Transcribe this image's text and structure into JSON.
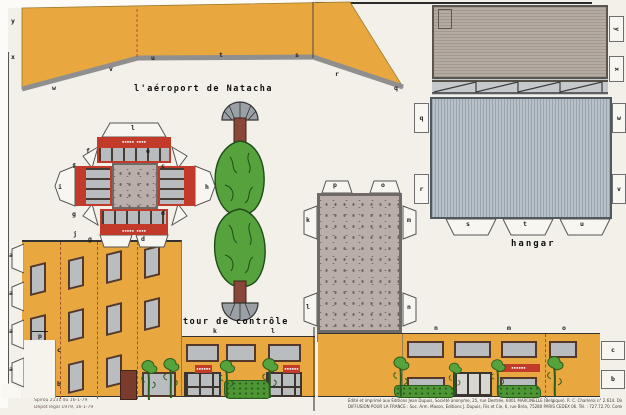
{
  "captions": {
    "airport_title": "l'aéroport de Natacha",
    "tower": "tour de contrôle",
    "hangar": "hangar"
  },
  "tab_letters": {
    "tarmac_left": [
      "y",
      "x"
    ],
    "tarmac_bottom": [
      "w",
      "v",
      "u",
      "t",
      "s",
      "r",
      "q"
    ],
    "roof_right": [
      "y",
      "x"
    ],
    "hangar_left": [
      "q",
      "r"
    ],
    "hangar_right": [
      "w",
      "v"
    ],
    "hangar_bottom": [
      "s",
      "t",
      "u"
    ],
    "tower": {
      "top": "l",
      "corner_tl": "f",
      "corner_tr": "e",
      "corner_r": "c",
      "corner_l": "f",
      "left": "i",
      "right": "h",
      "corner_bl": "g",
      "corner_br": "d",
      "bottom_l": "g",
      "bottom_r": "d"
    },
    "terminal_roof": {
      "top": [
        "p",
        "o"
      ],
      "right": [
        "m",
        "n"
      ],
      "left": [
        "k",
        "l"
      ]
    },
    "facade_left_edge": [
      "a",
      "a",
      "a",
      "a"
    ],
    "facade_top": [
      "j",
      "h"
    ],
    "facade_marks": {
      "p": "p",
      "c": "c",
      "b": "b"
    },
    "strip_center_top": [
      "k",
      "l"
    ],
    "strip_right_top": [
      "n",
      "m",
      "o"
    ],
    "strip_right_tabs": [
      "c",
      "b"
    ]
  },
  "signs": {
    "tower_band": "▪▪▪▪▪ ▪▪▪▪",
    "shop_sign": "▪▪▪▪▪▪"
  },
  "colophon": {
    "left_line1": "Spirou 2131 du 16-1-79",
    "left_line2": "Dépôt légal 1979, 16-1-79",
    "right_line1": "Édité et imprimé aux Éditions Jean Dupuis, Société anonyme, 25, rue Destrée, 6001 MARCINELLE (Belgique). R. C. Charleroi n° 2.614. Directeurs-administrateurs : MM. DUPUIS-MARTINEAUX.",
    "right_line2": "DIFFUSION POUR LA FRANCE : Soc. Arm. Mason, Éditions J. Dupuis, Fils et Cie, 6, rue Bréa, 75280 PARIS CEDEX 06. Tél. : 727.72.70. Commission paritaire de la Presse : N° 59.933 — 12.70 FF."
  },
  "colors": {
    "paper": "#f2f0e8",
    "tarmac_yellow": "#e8a83f",
    "roof_grey": "#b0a79f",
    "hangar_grey": "#b5bfc5",
    "speckle_grey": "#b9aeaa",
    "accent_red": "#c23b2a",
    "tree_green": "#56a23d",
    "trunk_brown": "#8a4638",
    "glass_grey": "#b9bdc0"
  }
}
